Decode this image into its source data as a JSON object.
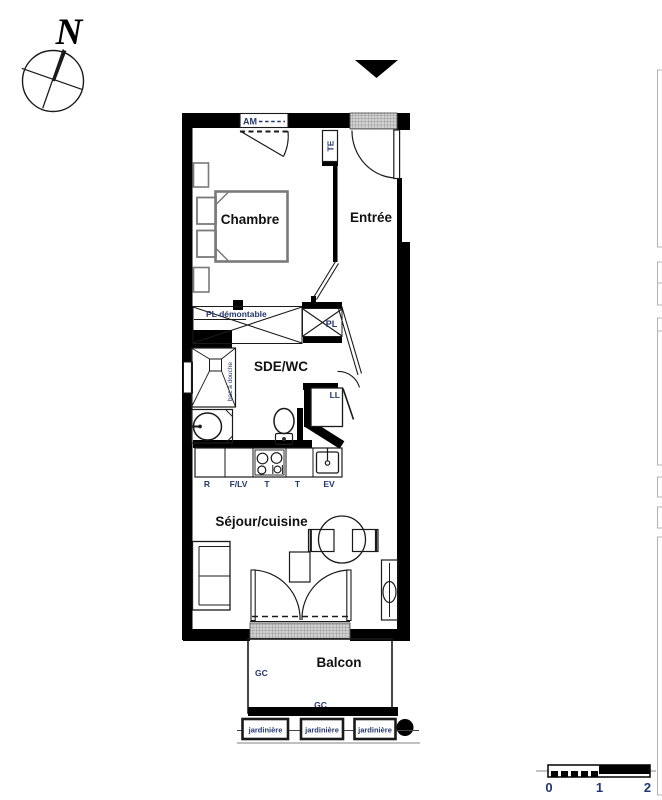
{
  "compass": {
    "north": "N"
  },
  "rooms": {
    "chambre": "Chambre",
    "entree": "Entrée",
    "sde_wc": "SDE/WC",
    "sejour_cuisine": "Séjour/cuisine",
    "balcon": "Balcon"
  },
  "labels": {
    "window": "AM",
    "electrical_panel": "TE",
    "pl_demontable": "PL démontable",
    "closet": "PL",
    "washing_machine": "LL",
    "shower_tray": "bac à douche",
    "fridge": "R",
    "oven_dishwasher": "F/LV",
    "worktop": "T",
    "sink": "EV",
    "railing": "GC",
    "planter": "jardinière"
  },
  "scale_bar": {
    "tick0": "0",
    "tick1": "1",
    "tick2": "2"
  },
  "colors": {
    "wall": "#000000",
    "annotation": "#23366e",
    "room_label": "#111111",
    "furniture": "#7a7a7a",
    "edge_bracket": "#b5b5b5",
    "grille_bg": "#d2d2d2",
    "grille_line": "#808080"
  }
}
